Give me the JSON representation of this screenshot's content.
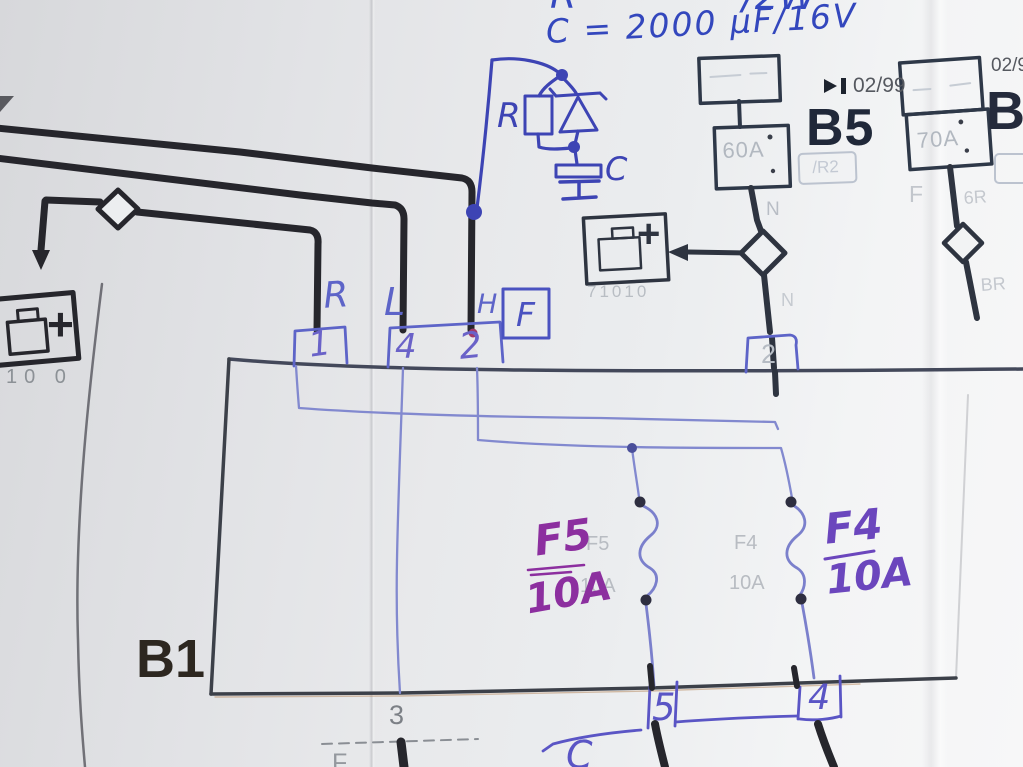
{
  "colors": {
    "ink_blue": "#3d44b4",
    "ink_violet": "#5d64c8",
    "ink_magenta": "#8c2f9f",
    "ink_purple": "#6b46bd",
    "print_dark": "#26262c",
    "print_faint": "#b2b8c0",
    "paper": "#e9eaec"
  },
  "hand": {
    "top_cut_left": "R",
    "top_cut_right": "/2W",
    "formula": "C = 2000 µF/16V",
    "rc_r": "R",
    "rc_c": "C",
    "conn_letters": [
      "R",
      "L",
      "H"
    ],
    "f_box": "F",
    "conn_numbers": [
      "1",
      "4",
      "2"
    ],
    "f5_name": "F5",
    "f5_rating": "10A",
    "f4_name": "F4",
    "f4_rating": "10A",
    "bottom_5": "5",
    "bottom_4": "4",
    "bottom_c": "C"
  },
  "print": {
    "b1": "B1",
    "b5": "B5",
    "b5_date": "02/99",
    "b5_fuse": "60A",
    "b5_ref": "/R2",
    "b9": "B9",
    "b9_date": "02/9",
    "b9_fuse": "70A",
    "left_battery_code": "10 0",
    "left_battery_plus": "+",
    "center_battery_code": "71010",
    "center_battery_plus": "+",
    "n_upper": "N",
    "n_lower": "N",
    "b9_left": "F",
    "b9_wire_upper": "6R",
    "b9_wire_lower": "BR",
    "faint_f5": "F5",
    "faint_f5_rating": "10A",
    "faint_f4": "F4",
    "faint_f4_rating": "10A",
    "conn2_right": "2",
    "bottom_3": "3",
    "bottom_f": "F"
  }
}
